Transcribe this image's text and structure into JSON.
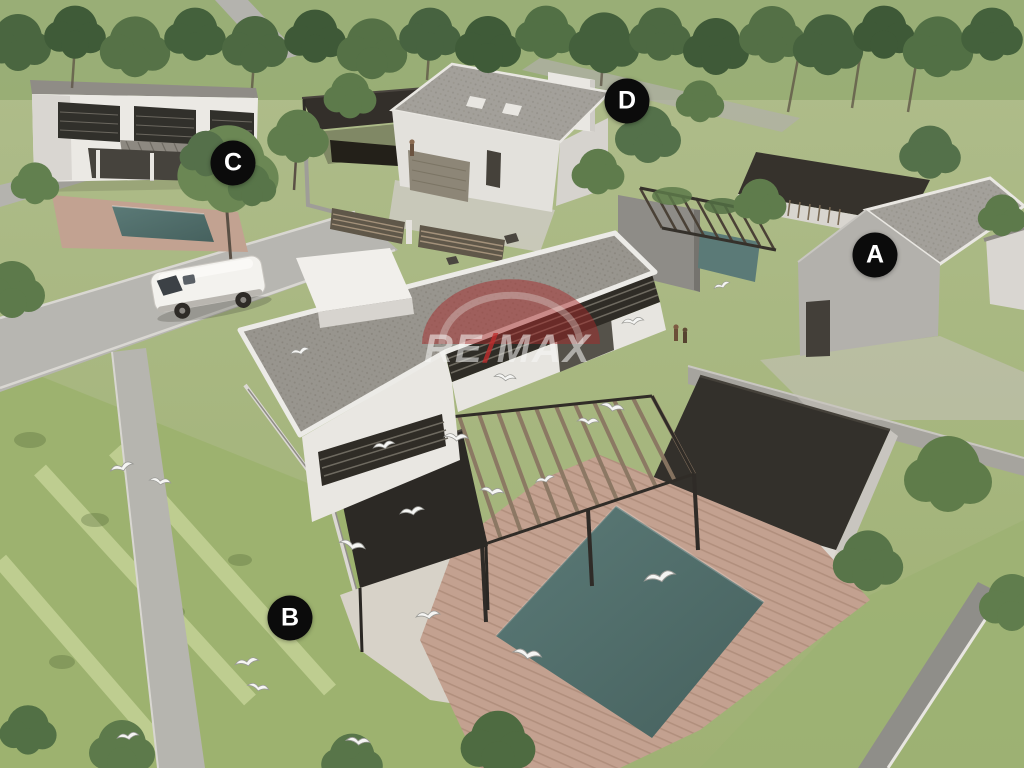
{
  "description": "Aerial 3D architectural rendering of a residential development with four lots (A, B, C, D), a main house with pergola and swimming pool, seagulls, trees and a white van. RE/MAX watermark over the main roof.",
  "markers": [
    {
      "label": "A",
      "x": 875,
      "y": 255
    },
    {
      "label": "B",
      "x": 290,
      "y": 618
    },
    {
      "label": "C",
      "x": 233,
      "y": 163
    },
    {
      "label": "D",
      "x": 627,
      "y": 101
    }
  ],
  "marker_style": {
    "background": "#0b0b0b",
    "text_color": "#ffffff"
  },
  "watermark": {
    "brand": "RE/MAX",
    "parts": [
      "RE",
      "/",
      "MAX"
    ],
    "balloon_color": "#a52a2a",
    "text_color": "rgba(248,248,246,0.55)",
    "slash_color": "rgba(190,45,45,0.8)"
  },
  "palette": {
    "grass_light": "#adbb88",
    "grass_dark": "#9fb174",
    "forest_green": "#4a6640",
    "road_gray": "#b7b6b1",
    "shingle_roof": "#98958e",
    "dark_roof": "#33302b",
    "white_wall": "#ebe9e4",
    "gray_wall": "#a09d99",
    "pool_teal": "#50706d",
    "deck_terracotta": "#c3a190",
    "wood_slat": "#8a7662",
    "louver_dark": "#2f2c26"
  }
}
